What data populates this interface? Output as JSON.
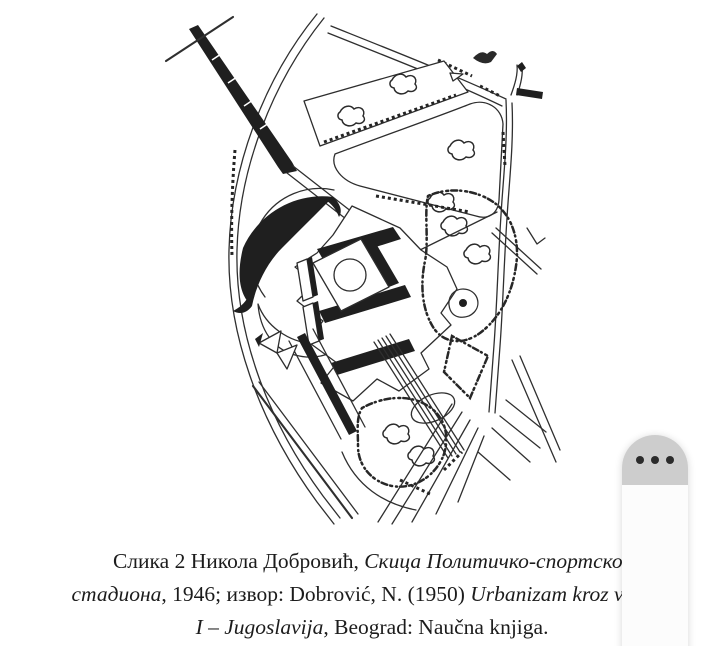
{
  "page": {
    "background_color": "#ffffff",
    "ink_color": "#2f2f2f"
  },
  "caption": {
    "lines": [
      {
        "runs": [
          {
            "text": "Слика 2 Никола Добровић, ",
            "style": "regular"
          },
          {
            "text": "Скица Политичко-спортског",
            "style": "italic"
          }
        ]
      },
      {
        "runs": [
          {
            "text": "стадиона",
            "style": "italic"
          },
          {
            "text": ", 1946; извор: Dobrović, N. (1950) ",
            "style": "regular"
          },
          {
            "text": "Urbanizam kroz vekove",
            "style": "italic"
          }
        ]
      },
      {
        "runs": [
          {
            "text": "I – Jugoslavija",
            "style": "italic"
          },
          {
            "text": ", Beograd: Naučna knjiga.",
            "style": "regular"
          }
        ]
      }
    ]
  },
  "overlay_menu": {
    "icon": "ellipsis-icon",
    "cap_color": "#cdcdcd",
    "body_color": "#fcfcfc",
    "dot_color": "#2b2b2b"
  }
}
